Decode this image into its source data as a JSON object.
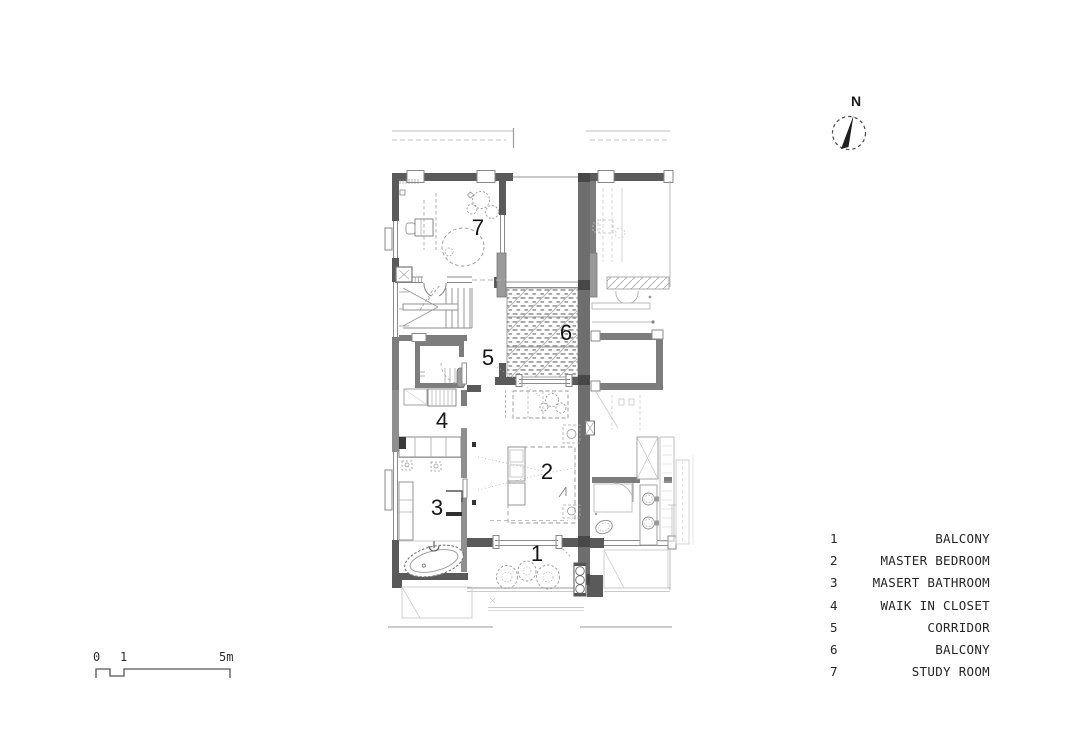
{
  "compass": {
    "label": "N"
  },
  "scalebar": {
    "labels": {
      "start": "0",
      "mid": "1",
      "end": "5m"
    }
  },
  "plan": {
    "room_numbers": {
      "balcony_lower": "1",
      "master_bedroom": "2",
      "master_bathroom": "3",
      "walk_in_closet": "4",
      "corridor": "5",
      "balcony_upper": "6",
      "study_room": "7"
    }
  },
  "legend": {
    "entries": [
      {
        "num": "1",
        "name": "BALCONY"
      },
      {
        "num": "2",
        "name": "MASTER BEDROOM"
      },
      {
        "num": "3",
        "name": "MASERT BATHROOM"
      },
      {
        "num": "4",
        "name": "WAIK IN CLOSET"
      },
      {
        "num": "5",
        "name": "CORRIDOR"
      },
      {
        "num": "6",
        "name": "BALCONY"
      },
      {
        "num": "7",
        "name": "STUDY ROOM"
      }
    ]
  },
  "colors": {
    "wall_dark": "#5a5a5a",
    "wall_medium": "#7d7d7d",
    "party_wall": "#6e6e6e",
    "line": "#8c8c8c",
    "ink": "#161616"
  }
}
